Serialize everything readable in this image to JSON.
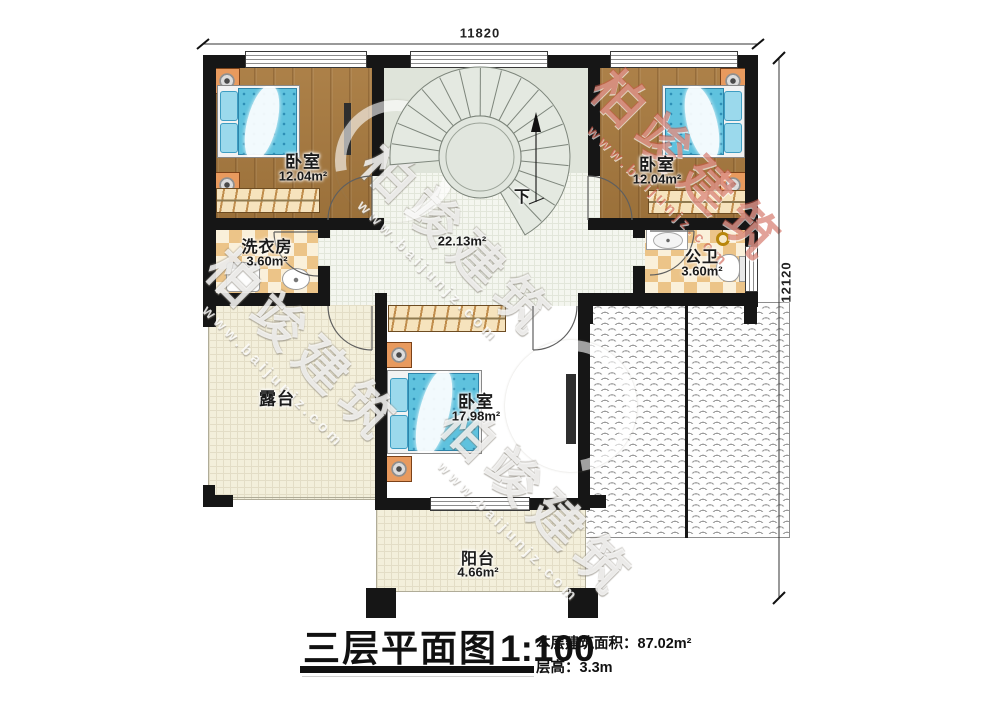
{
  "dimensions": {
    "top": "11820",
    "right": "12120"
  },
  "rooms": {
    "bedroom_left": {
      "name": "卧室",
      "area": "12.04m²"
    },
    "bedroom_right": {
      "name": "卧室",
      "area": "12.04m²"
    },
    "laundry": {
      "name": "洗衣房",
      "area": "3.60m²"
    },
    "bathroom": {
      "name": "公卫",
      "area": "3.60m²"
    },
    "hallway": {
      "area": "22.13m²"
    },
    "terrace": {
      "name": "露台"
    },
    "bedroom_master": {
      "name": "卧室",
      "area": "17.98m²"
    },
    "balcony": {
      "name": "阳台",
      "area": "4.66m²"
    }
  },
  "stair": {
    "direction_label": "下"
  },
  "title_block": {
    "title": "三层平面图",
    "scale": "1:100",
    "floor_area_label": "本层建筑面积：",
    "floor_area_value": "87.02m²",
    "floor_height_label": "层高：",
    "floor_height_value": "3.3m"
  },
  "watermark": {
    "brand": "柏竣建筑",
    "url": "www.baijunjz.com"
  },
  "colors": {
    "wall": "#161616",
    "wood_floor": "#a87a3f",
    "bed_blue": "#5fc2de",
    "stair_floor": "#dfe4da",
    "tile_checker": "#ecc488",
    "terrace_cream": "#f3efdb",
    "watermark_red": "#cb5646"
  }
}
